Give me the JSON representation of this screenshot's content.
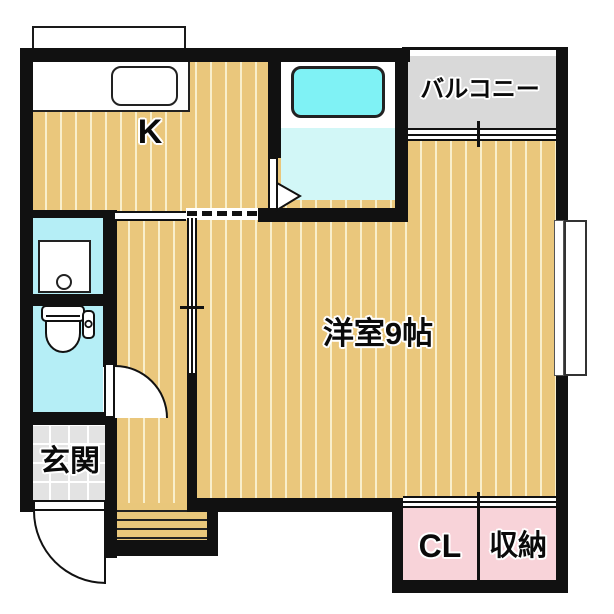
{
  "title": "1K apartment floor plan",
  "rooms": {
    "kitchen": {
      "label": "K"
    },
    "balcony": {
      "label": "バルコニー"
    },
    "main_room": {
      "label": "洋室9帖"
    },
    "entrance": {
      "label": "玄関"
    },
    "closet": {
      "label": "CL"
    },
    "storage": {
      "label": "収納"
    }
  },
  "fixtures": {
    "kitchen_sink": "kitchen-sink",
    "bathtub": "bathtub",
    "washing_machine_pan": "washing-machine-pan",
    "toilet": "toilet",
    "entrance_door": "entrance-swing-door",
    "toilet_door": "toilet-swing-door",
    "bathroom_door": "bathroom-door",
    "balcony_window": "sliding-window",
    "closet_doors": "sliding-doors",
    "side_window": "bay-window",
    "entrance_step": "entrance-step"
  },
  "colors": {
    "wall": "#111111",
    "wood_floor": "#EAC77C",
    "wood_stripe": "#F9EFCB",
    "wet_area": "#B5EEF6",
    "bath_floor": "#D2F7F7",
    "bathtub": "#7FF2F5",
    "balcony": "#D9D9D9",
    "entrance_tile": "#E3E3E3",
    "closet_pink": "#F8D3D9"
  }
}
